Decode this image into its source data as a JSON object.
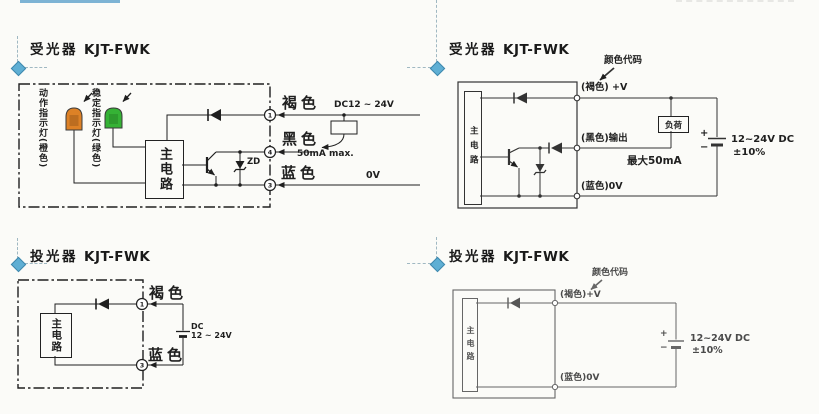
{
  "page": {
    "accent_line_color": "#7db3d4",
    "marker_color": "#5fafd4",
    "ink_color": "#1f1f1f"
  },
  "receiver_left": {
    "title_cjk": "受光器",
    "title_model": "KJT-FWK",
    "operation_indicator_label": "动作指示灯(橙色)",
    "stability_indicator_label": "稳定指示灯(绿色)",
    "main_circuit": "主电路",
    "wire_brown": "褐色",
    "wire_black": "黑色",
    "wire_blue": "蓝色",
    "supply": "DC12 ~ 24V",
    "current_max": "50mA max.",
    "zero_volt": "0V",
    "zener_label": "ZD",
    "terminal_brown": "1",
    "terminal_black": "4",
    "terminal_blue": "3",
    "lamp_operation_color": "#dd8126",
    "lamp_stability_color": "#35b235"
  },
  "receiver_right": {
    "title_cjk": "受光器",
    "title_model": "KJT-FWK",
    "color_code": "颜色代码",
    "wire_brown": "(褐色) +V",
    "wire_black": "(黑色)输出",
    "wire_blue": "(蓝色)0V",
    "load": "负荷",
    "current_max": "最大50mA",
    "main_circuit": "主电路",
    "supply": "12~24V DC",
    "tolerance": "±10%",
    "plus": "+",
    "minus": "−"
  },
  "transmitter_left": {
    "title_cjk": "投光器",
    "title_model": "KJT-FWK",
    "main_circuit": "主电路",
    "wire_brown": "褐色",
    "wire_blue": "蓝色",
    "supply_line1": "DC",
    "supply_line2": "12 ~ 24V",
    "terminal_brown": "1",
    "terminal_blue": "3"
  },
  "transmitter_right": {
    "title_cjk": "投光器",
    "title_model": "KJT-FWK",
    "color_code": "颜色代码",
    "wire_brown": "(褐色)+V",
    "wire_blue": "(蓝色)0V",
    "main_circuit": "主电路",
    "supply": "12~24V DC",
    "tolerance": "±10%",
    "plus": "+",
    "minus": "−"
  }
}
